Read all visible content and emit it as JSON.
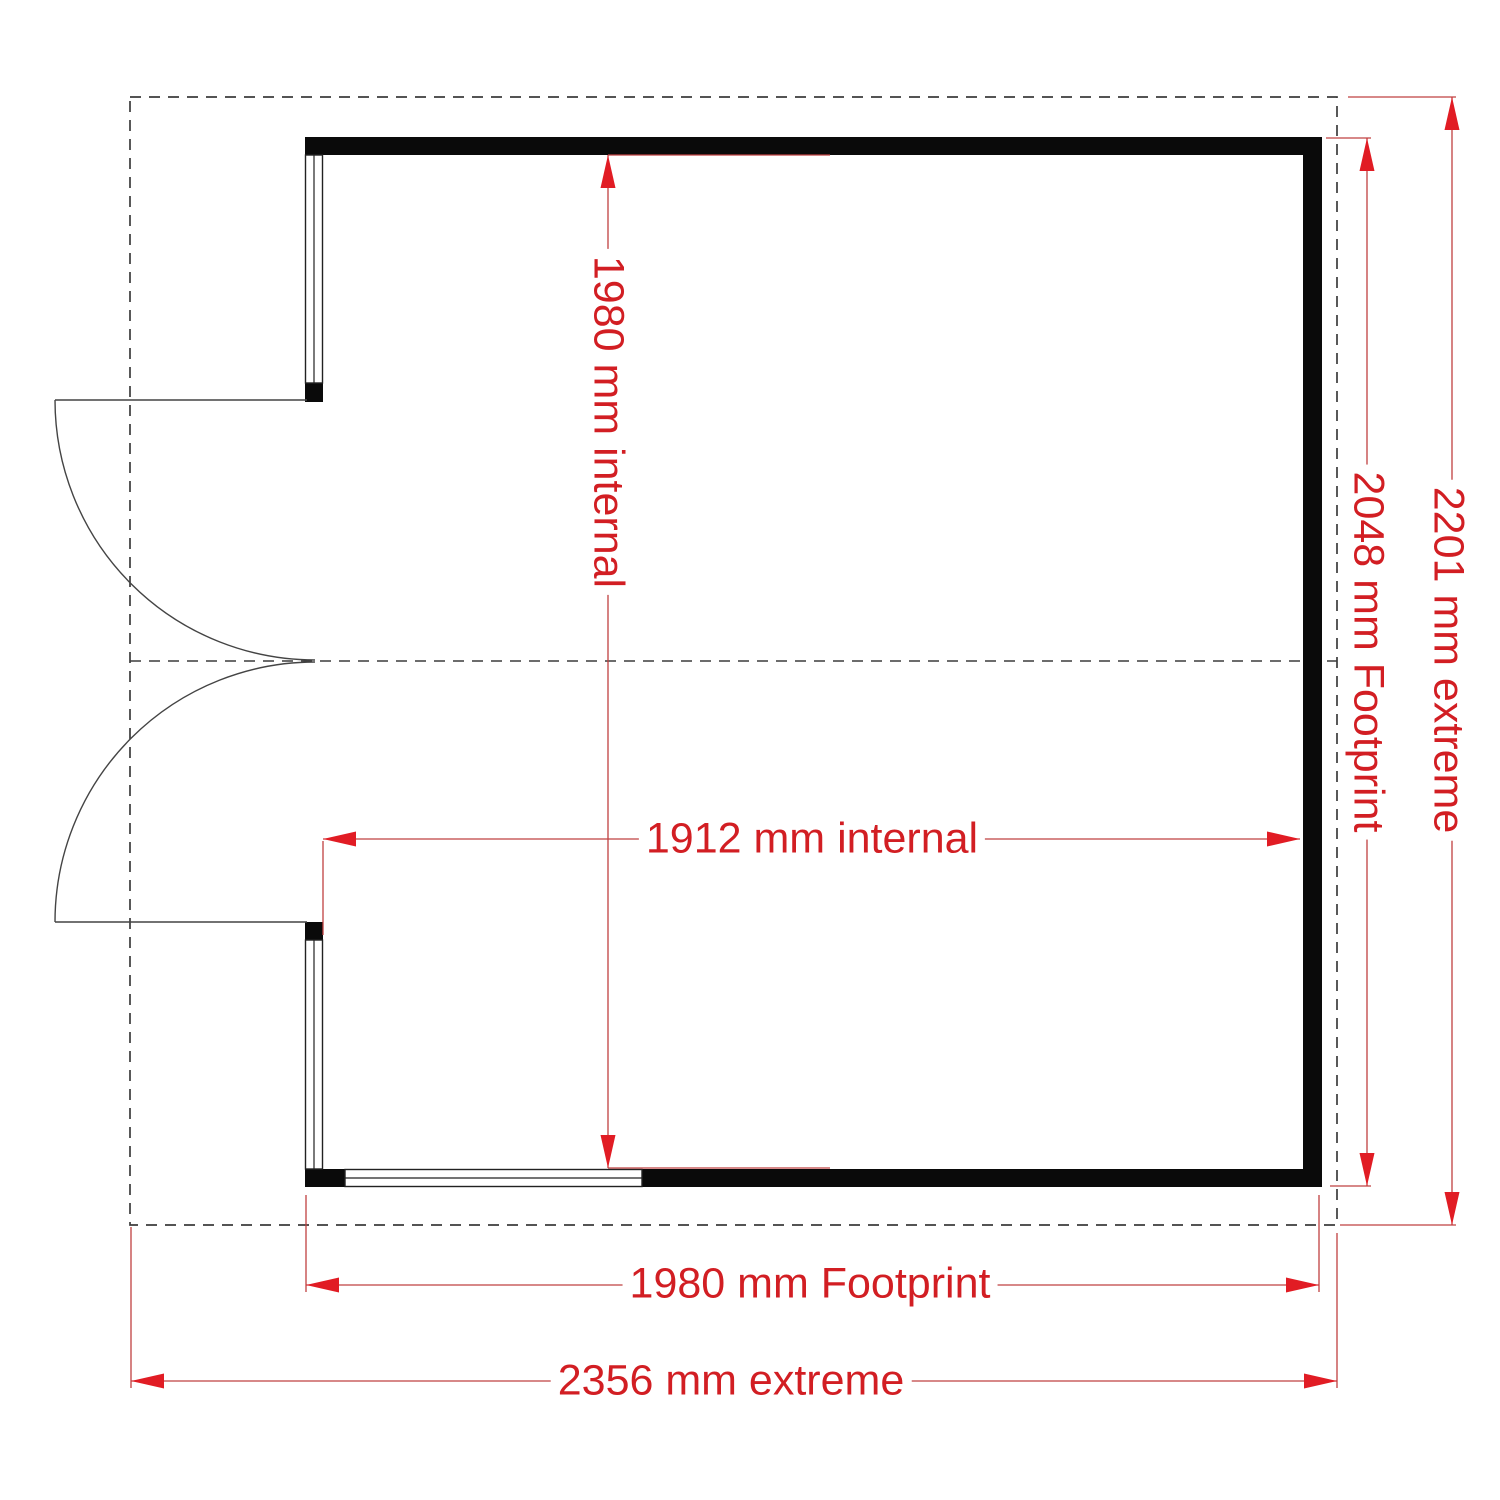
{
  "drawing": {
    "kind": "floor-plan",
    "colors": {
      "dimension_red": "#d21e23",
      "arrow_red": "#e11c24",
      "wall_black": "#0a0a0a",
      "outline_gray": "#3c3c3c"
    },
    "dimensions": {
      "internal_height": {
        "label": "1980 mm internal",
        "orientation": "vertical"
      },
      "internal_width": {
        "label": "1912 mm internal",
        "orientation": "horizontal"
      },
      "footprint_height": {
        "label": "2048 mm Footprint",
        "orientation": "vertical"
      },
      "extreme_height": {
        "label": "2201 mm extreme",
        "orientation": "vertical"
      },
      "footprint_width": {
        "label": "1980 mm Footprint",
        "orientation": "horizontal"
      },
      "extreme_width": {
        "label": "2356 mm extreme",
        "orientation": "horizontal"
      }
    }
  }
}
